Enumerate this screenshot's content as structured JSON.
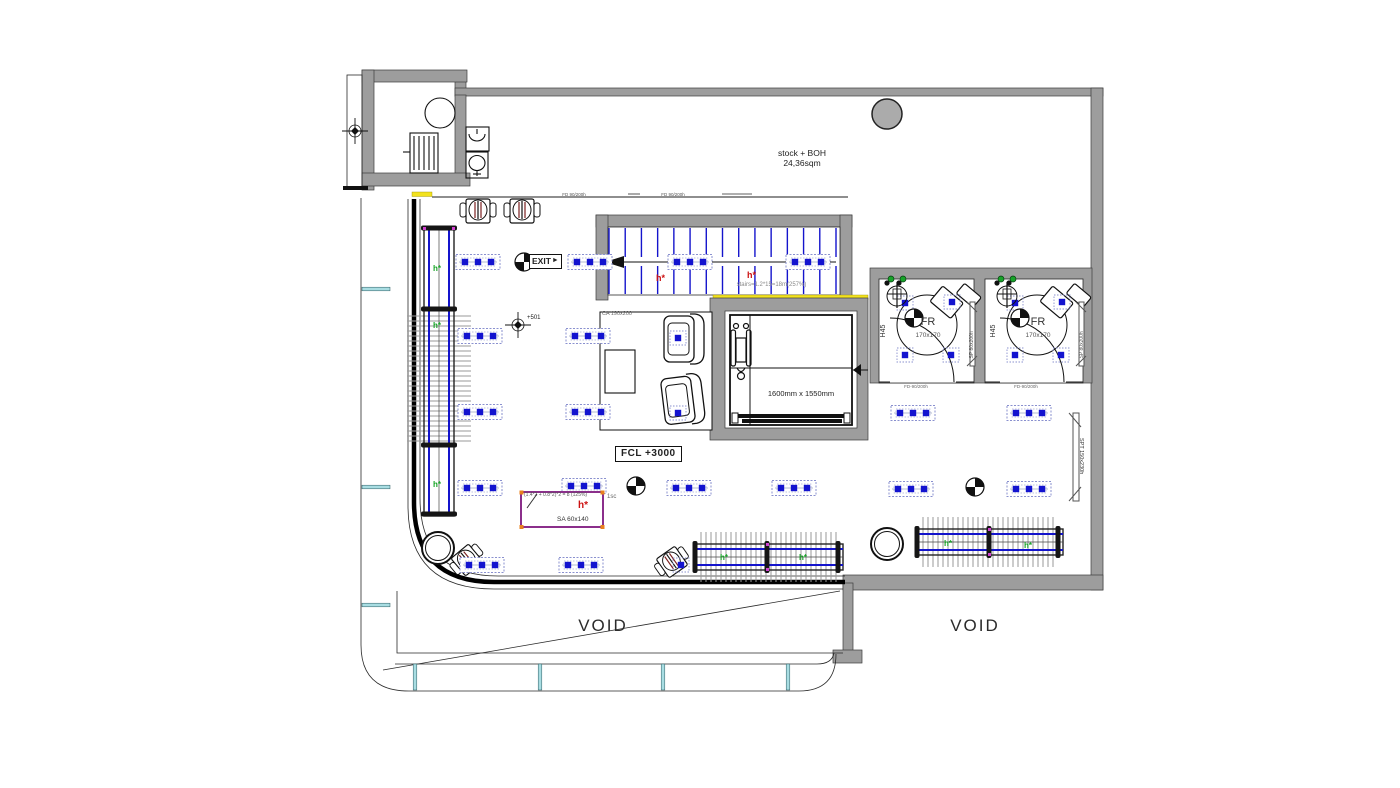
{
  "labels": {
    "stock_boh_1": "stock + BOH",
    "stock_boh_2": "24,36sqm",
    "exit": "EXIT",
    "exit_arrow": "►",
    "fcl": "FCL +3000",
    "lift_size": "1600mm x 1550mm",
    "ca": "CA 190x200",
    "level": "+501",
    "sa_formula": "(1.4*2 + 0.8*2)*2 = 8 (125%)",
    "sa_scale": "1sc",
    "h_red": "h*",
    "h_green": "h*",
    "sa_name": "SA 60x140",
    "stairs_note": "stairs=1.2*15=18m(257%)",
    "void_left": "VOID",
    "void_right": "VOID",
    "spt": "SPT 150x230h",
    "door_top": "FD 90/200h",
    "fr_door": "FD-90/200h",
    "fr1": {
      "name": "FR",
      "size": "170x170",
      "h45": "H45",
      "sp": "SP 80x200h"
    },
    "fr2": {
      "name": "FR",
      "size": "170x170",
      "h45": "H45",
      "sp": "SP 80x200h"
    }
  },
  "colors": {
    "wall_gray": "#9d9d9d",
    "fixture_blue": "#1414cc",
    "door_yellow": "#f2e21e",
    "glazing_cyan": "#a8dde2",
    "sa_purple": "#8b2f8b",
    "note_red": "#cc1111",
    "rack_green": "#17a326"
  },
  "symbols": {
    "lights": [
      [
        478,
        262
      ],
      [
        590,
        262
      ],
      [
        690,
        262
      ],
      [
        808,
        262
      ],
      [
        480,
        336
      ],
      [
        588,
        336
      ],
      [
        480,
        412
      ],
      [
        588,
        412
      ],
      [
        913,
        413
      ],
      [
        1029,
        413
      ],
      [
        480,
        488
      ],
      [
        584,
        486
      ],
      [
        689,
        488
      ],
      [
        794,
        488
      ],
      [
        911,
        489
      ],
      [
        1029,
        489
      ],
      [
        482,
        565
      ],
      [
        581,
        565
      ]
    ],
    "spots": [
      [
        905,
        303
      ],
      [
        952,
        302
      ],
      [
        905,
        355
      ],
      [
        951,
        355
      ],
      [
        1015,
        303
      ],
      [
        1062,
        302
      ],
      [
        1015,
        355
      ],
      [
        1061,
        355
      ],
      [
        678,
        338
      ],
      [
        678,
        413
      ],
      [
        681,
        565
      ]
    ],
    "quadrants": [
      [
        524,
        262
      ],
      [
        636,
        486
      ],
      [
        975,
        487
      ],
      [
        914,
        318
      ],
      [
        1020,
        318
      ]
    ],
    "crosses": [
      [
        355,
        131
      ],
      [
        518,
        325
      ]
    ],
    "hooks_black": [
      [
        887,
        283
      ],
      [
        899,
        283
      ],
      [
        997,
        283
      ],
      [
        1009,
        283
      ]
    ],
    "hooks_green": [
      [
        891,
        279
      ],
      [
        903,
        279
      ],
      [
        1001,
        279
      ],
      [
        1013,
        279
      ]
    ],
    "fans": [
      [
        897,
        296
      ],
      [
        1007,
        296
      ]
    ],
    "columns_open": [
      [
        438,
        548
      ],
      [
        887,
        544
      ]
    ],
    "columns_filled": [
      [
        887,
        114
      ]
    ],
    "mullions_left_y": [
      289,
      487,
      605
    ],
    "mullions_bottom_x": [
      415,
      540,
      663,
      788
    ],
    "green_h_pos": [
      [
        433,
        271
      ],
      [
        433,
        328
      ],
      [
        433,
        487
      ],
      [
        720,
        560
      ],
      [
        799,
        560
      ],
      [
        944,
        546
      ],
      [
        1024,
        548
      ]
    ],
    "red_h_pos": [
      [
        656,
        281
      ],
      [
        747,
        278
      ]
    ],
    "racks": [
      {
        "dir": "v",
        "cx": 439,
        "a0": 228,
        "a1": 516,
        "caps": [
          228,
          309,
          445,
          514
        ],
        "ticks": [
          316,
          442
        ],
        "tickStep": 5,
        "tickLen": 64,
        "railOff": 10,
        "width": 30
      },
      {
        "dir": "h",
        "cx": 557,
        "a0": 695,
        "a1": 843,
        "caps": [
          695,
          767,
          838
        ],
        "ticks": [
          701,
          837
        ],
        "tickStep": 5,
        "tickLen": 50,
        "railOff": 8,
        "width": 26
      },
      {
        "dir": "h",
        "cx": 542,
        "a0": 917,
        "a1": 1063,
        "caps": [
          917,
          989,
          1058
        ],
        "ticks": [
          923,
          1057
        ],
        "tickStep": 5,
        "tickLen": 50,
        "railOff": 8,
        "width": 26
      }
    ],
    "treads": {
      "x0": 609,
      "x1": 836,
      "count": 15,
      "y0": 228,
      "y1": 294
    }
  }
}
